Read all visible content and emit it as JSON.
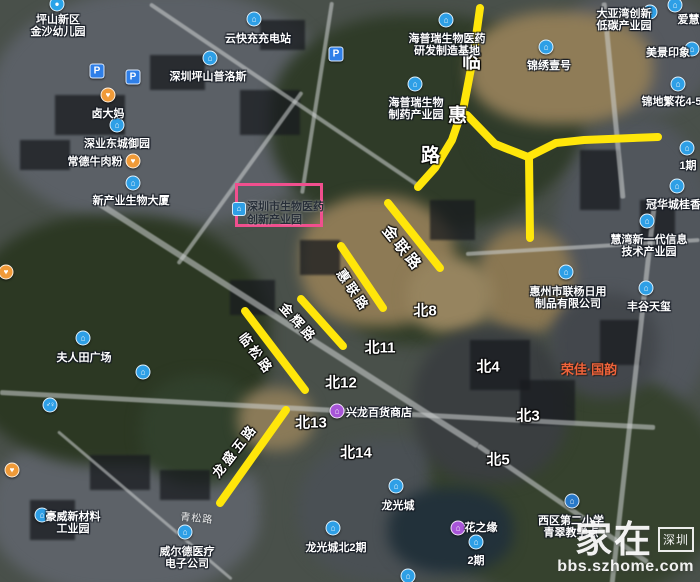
{
  "highlight_box": {
    "x": 235,
    "y": 183,
    "w": 88,
    "h": 44,
    "color": "#f14f8e",
    "lines": [
      "深圳市生物医药",
      "创新产业园"
    ]
  },
  "road_highlight_color": "#ffe60a",
  "yellow_roads": [
    {
      "id": "linhui-road",
      "points": [
        [
          480,
          8
        ],
        [
          473,
          58
        ],
        [
          464,
          105
        ],
        [
          452,
          140
        ],
        [
          435,
          168
        ],
        [
          418,
          187
        ]
      ]
    },
    {
      "id": "fork-east",
      "points": [
        [
          467,
          115
        ],
        [
          495,
          144
        ],
        [
          528,
          157
        ]
      ]
    },
    {
      "id": "east-arm",
      "points": [
        [
          528,
          157
        ],
        [
          556,
          143
        ],
        [
          584,
          140
        ],
        [
          658,
          137
        ]
      ]
    },
    {
      "id": "south-arm",
      "points": [
        [
          529,
          157
        ],
        [
          530,
          238
        ]
      ]
    },
    {
      "id": "jinlian-road",
      "points": [
        [
          388,
          203
        ],
        [
          440,
          268
        ]
      ]
    },
    {
      "id": "huilian-road",
      "points": [
        [
          341,
          246
        ],
        [
          383,
          308
        ]
      ]
    },
    {
      "id": "jinhui-road",
      "points": [
        [
          301,
          299
        ],
        [
          343,
          346
        ]
      ]
    },
    {
      "id": "linsong-road",
      "points": [
        [
          245,
          311
        ],
        [
          305,
          390
        ]
      ]
    },
    {
      "id": "longshengwu-road",
      "points": [
        [
          286,
          410
        ],
        [
          220,
          503
        ]
      ]
    }
  ],
  "road_labels": [
    {
      "id": "linhui-char-lin",
      "text": "临",
      "x": 473,
      "y": 60,
      "rot": 0,
      "size": 19
    },
    {
      "id": "linhui-char-hui",
      "text": "惠",
      "x": 459,
      "y": 114,
      "rot": 0,
      "size": 19
    },
    {
      "id": "linhui-char-lu",
      "text": "路",
      "x": 432,
      "y": 154,
      "rot": 0,
      "size": 19
    },
    {
      "id": "jinlian-label",
      "text": "金联路",
      "x": 403,
      "y": 248,
      "rot": 51,
      "size": 15
    },
    {
      "id": "huilian-label",
      "text": "惠联路",
      "x": 354,
      "y": 290,
      "rot": 56,
      "size": 13
    },
    {
      "id": "jinhui-label",
      "text": "金辉路",
      "x": 299,
      "y": 322,
      "rot": 48,
      "size": 13
    },
    {
      "id": "linsong-label",
      "text": "临松路",
      "x": 257,
      "y": 353,
      "rot": 53,
      "size": 13
    },
    {
      "id": "longshengwu-label",
      "text": "龙盛五路",
      "x": 234,
      "y": 450,
      "rot": -52,
      "size": 13
    },
    {
      "id": "qingsong-label",
      "text": "青松路",
      "x": 197,
      "y": 517,
      "rot": 6,
      "size": 10,
      "small": true
    }
  ],
  "district_labels": [
    {
      "id": "bei8",
      "text": "北8",
      "x": 425,
      "y": 310
    },
    {
      "id": "bei11",
      "text": "北11",
      "x": 380,
      "y": 347
    },
    {
      "id": "bei12",
      "text": "北12",
      "x": 341,
      "y": 382
    },
    {
      "id": "bei13",
      "text": "北13",
      "x": 311,
      "y": 422
    },
    {
      "id": "bei14",
      "text": "北14",
      "x": 356,
      "y": 452
    },
    {
      "id": "bei4",
      "text": "北4",
      "x": 488,
      "y": 366
    },
    {
      "id": "bei3",
      "text": "北3",
      "x": 528,
      "y": 415
    },
    {
      "id": "bei5",
      "text": "北5",
      "x": 498,
      "y": 459
    }
  ],
  "pois": [
    {
      "id": "jinsha-kindergarten",
      "lines": [
        "坪山新区",
        "金沙幼儿园"
      ],
      "x": 58,
      "y": 14,
      "icon": "pin",
      "ix": 57,
      "iy": 4
    },
    {
      "id": "pingshan-prologis",
      "lines": [
        "深圳坪山普洛斯"
      ],
      "x": 208,
      "y": 71,
      "icon": "b",
      "ix": 210,
      "iy": 58
    },
    {
      "id": "yunkuaichong",
      "lines": [
        "云快充充电站"
      ],
      "x": 258,
      "y": 33,
      "icon": "b",
      "ix": 254,
      "iy": 19
    },
    {
      "id": "ludama",
      "lines": [
        "卤大妈"
      ],
      "x": 108,
      "y": 108,
      "icon": "food",
      "ix": 108,
      "iy": 95
    },
    {
      "id": "shenye-dongcheng",
      "lines": [
        "深业东城御园"
      ],
      "x": 117,
      "y": 138,
      "icon": "b",
      "ix": 117,
      "iy": 125
    },
    {
      "id": "changde-beef",
      "lines": [
        "常德牛肉粉"
      ],
      "x": 95,
      "y": 156,
      "icon": "food",
      "ix": 133,
      "iy": 161
    },
    {
      "id": "haipurui-base",
      "lines": [
        "海普瑞生物医药",
        "研发制造基地"
      ],
      "x": 447,
      "y": 33,
      "icon": "b",
      "ix": 446,
      "iy": 20
    },
    {
      "id": "haipurui-park",
      "lines": [
        "海普瑞生物",
        "制药产业园"
      ],
      "x": 416,
      "y": 97,
      "icon": "b",
      "ix": 415,
      "iy": 84
    },
    {
      "id": "dayawan-park",
      "lines": [
        "大亚湾创新",
        "低碳产业园"
      ],
      "x": 624,
      "y": 8,
      "icon": "b",
      "ix": 650,
      "iy": 12
    },
    {
      "id": "aihuiwan",
      "lines": [
        "爱慧湾"
      ],
      "x": 694,
      "y": 14,
      "icon": "b",
      "ix": 675,
      "iy": 5
    },
    {
      "id": "jinxiu-yihao",
      "lines": [
        "锦绣壹号"
      ],
      "x": 549,
      "y": 60,
      "icon": "b",
      "ix": 546,
      "iy": 47
    },
    {
      "id": "meijing-yinxiang",
      "lines": [
        "美景印象"
      ],
      "x": 668,
      "y": 47,
      "icon": "b",
      "ix": 692,
      "iy": 49
    },
    {
      "id": "jindi-fanhua",
      "lines": [
        "锦地繁花4-5期"
      ],
      "x": 677,
      "y": 96,
      "icon": "b",
      "ix": 678,
      "iy": 84
    },
    {
      "id": "yi-qi",
      "lines": [
        "1期"
      ],
      "x": 688,
      "y": 160,
      "icon": "b",
      "ix": 687,
      "iy": 148
    },
    {
      "id": "guanhuacheng",
      "lines": [
        "冠华城桂香园"
      ],
      "x": 679,
      "y": 199,
      "icon": "b",
      "ix": 677,
      "iy": 186
    },
    {
      "id": "huiwan-info",
      "lines": [
        "慧湾新一代信息",
        "技术产业园"
      ],
      "x": 649,
      "y": 234,
      "icon": "b",
      "ix": 647,
      "iy": 221
    },
    {
      "id": "xinchanye-tower",
      "lines": [
        "新产业生物大厦"
      ],
      "x": 131,
      "y": 195,
      "icon": "b",
      "ix": 133,
      "iy": 183
    },
    {
      "id": "lianyang-co",
      "lines": [
        "惠州市联杨日用",
        "制品有限公司"
      ],
      "x": 568,
      "y": 286,
      "icon": "b",
      "ix": 566,
      "iy": 272
    },
    {
      "id": "fenggu-tianxi",
      "lines": [
        "丰谷天玺"
      ],
      "x": 649,
      "y": 301,
      "icon": "b",
      "ix": 646,
      "iy": 288
    },
    {
      "id": "furentian-square",
      "lines": [
        "夫人田广场"
      ],
      "x": 84,
      "y": 352,
      "icon": "b",
      "ix": 83,
      "iy": 338
    },
    {
      "id": "xinglong-store",
      "lines": [
        "兴龙百货商店"
      ],
      "x": 379,
      "y": 407,
      "icon": "shop",
      "ix": 337,
      "iy": 411
    },
    {
      "id": "longguangcheng",
      "lines": [
        "龙光城"
      ],
      "x": 398,
      "y": 500,
      "icon": "b",
      "ix": 396,
      "iy": 486
    },
    {
      "id": "longguang-north2",
      "lines": [
        "龙光城北2期"
      ],
      "x": 336,
      "y": 542,
      "icon": "b",
      "ix": 333,
      "iy": 528
    },
    {
      "id": "xiqu-school",
      "lines": [
        "西区第二小学",
        "青翠教学点"
      ],
      "x": 571,
      "y": 515,
      "icon": "school",
      "ix": 572,
      "iy": 501
    },
    {
      "id": "huazhiyuan",
      "lines": [
        "花之缘"
      ],
      "x": 481,
      "y": 522,
      "icon": "none",
      "ix": 0,
      "iy": 0
    },
    {
      "id": "er-qi",
      "lines": [
        "2期"
      ],
      "x": 476,
      "y": 555,
      "icon": "b",
      "ix": 476,
      "iy": 542
    },
    {
      "id": "weierde",
      "lines": [
        "威尔德医疗",
        "电子公司"
      ],
      "x": 187,
      "y": 546,
      "icon": "b",
      "ix": 185,
      "iy": 532
    },
    {
      "id": "haowei",
      "lines": [
        "豪威新材料",
        "工业园"
      ],
      "x": 73,
      "y": 511,
      "icon": "b",
      "ix": 42,
      "iy": 515
    },
    {
      "id": "rongjia-guoyun",
      "lines": [
        "荣佳·国韵"
      ],
      "x": 589,
      "y": 364,
      "icon": "none",
      "ix": 0,
      "iy": 0,
      "orange": true
    }
  ],
  "standalone_icons": [
    {
      "id": "parking-1",
      "type": "p",
      "x": 97,
      "y": 71,
      "glyph": "P"
    },
    {
      "id": "parking-2",
      "type": "p",
      "x": 133,
      "y": 77,
      "glyph": "P"
    },
    {
      "id": "parking-3",
      "type": "p",
      "x": 336,
      "y": 54,
      "glyph": "P"
    },
    {
      "id": "restroom",
      "type": "wc",
      "x": 50,
      "y": 405,
      "glyph": "♂♀"
    },
    {
      "id": "food-west",
      "type": "food",
      "x": 6,
      "y": 272,
      "glyph": "♥"
    },
    {
      "id": "food-southwest",
      "type": "food",
      "x": 12,
      "y": 470,
      "glyph": "♥"
    },
    {
      "id": "poi-hill",
      "type": "b",
      "x": 143,
      "y": 372,
      "glyph": "⌂"
    },
    {
      "id": "shop-east",
      "type": "shop",
      "x": 458,
      "y": 528,
      "glyph": "⌂"
    },
    {
      "id": "poi-bottom",
      "type": "b",
      "x": 408,
      "y": 576,
      "glyph": "⌂"
    }
  ],
  "icon_glyphs": {
    "b": "⌂",
    "pin": "●",
    "food": "♥",
    "shop": "⌂",
    "school": "⌂",
    "p": "P",
    "wc": "♂♀"
  },
  "watermark": {
    "brand": "家在",
    "region": "深圳",
    "url": "bbs.szhome.com"
  }
}
